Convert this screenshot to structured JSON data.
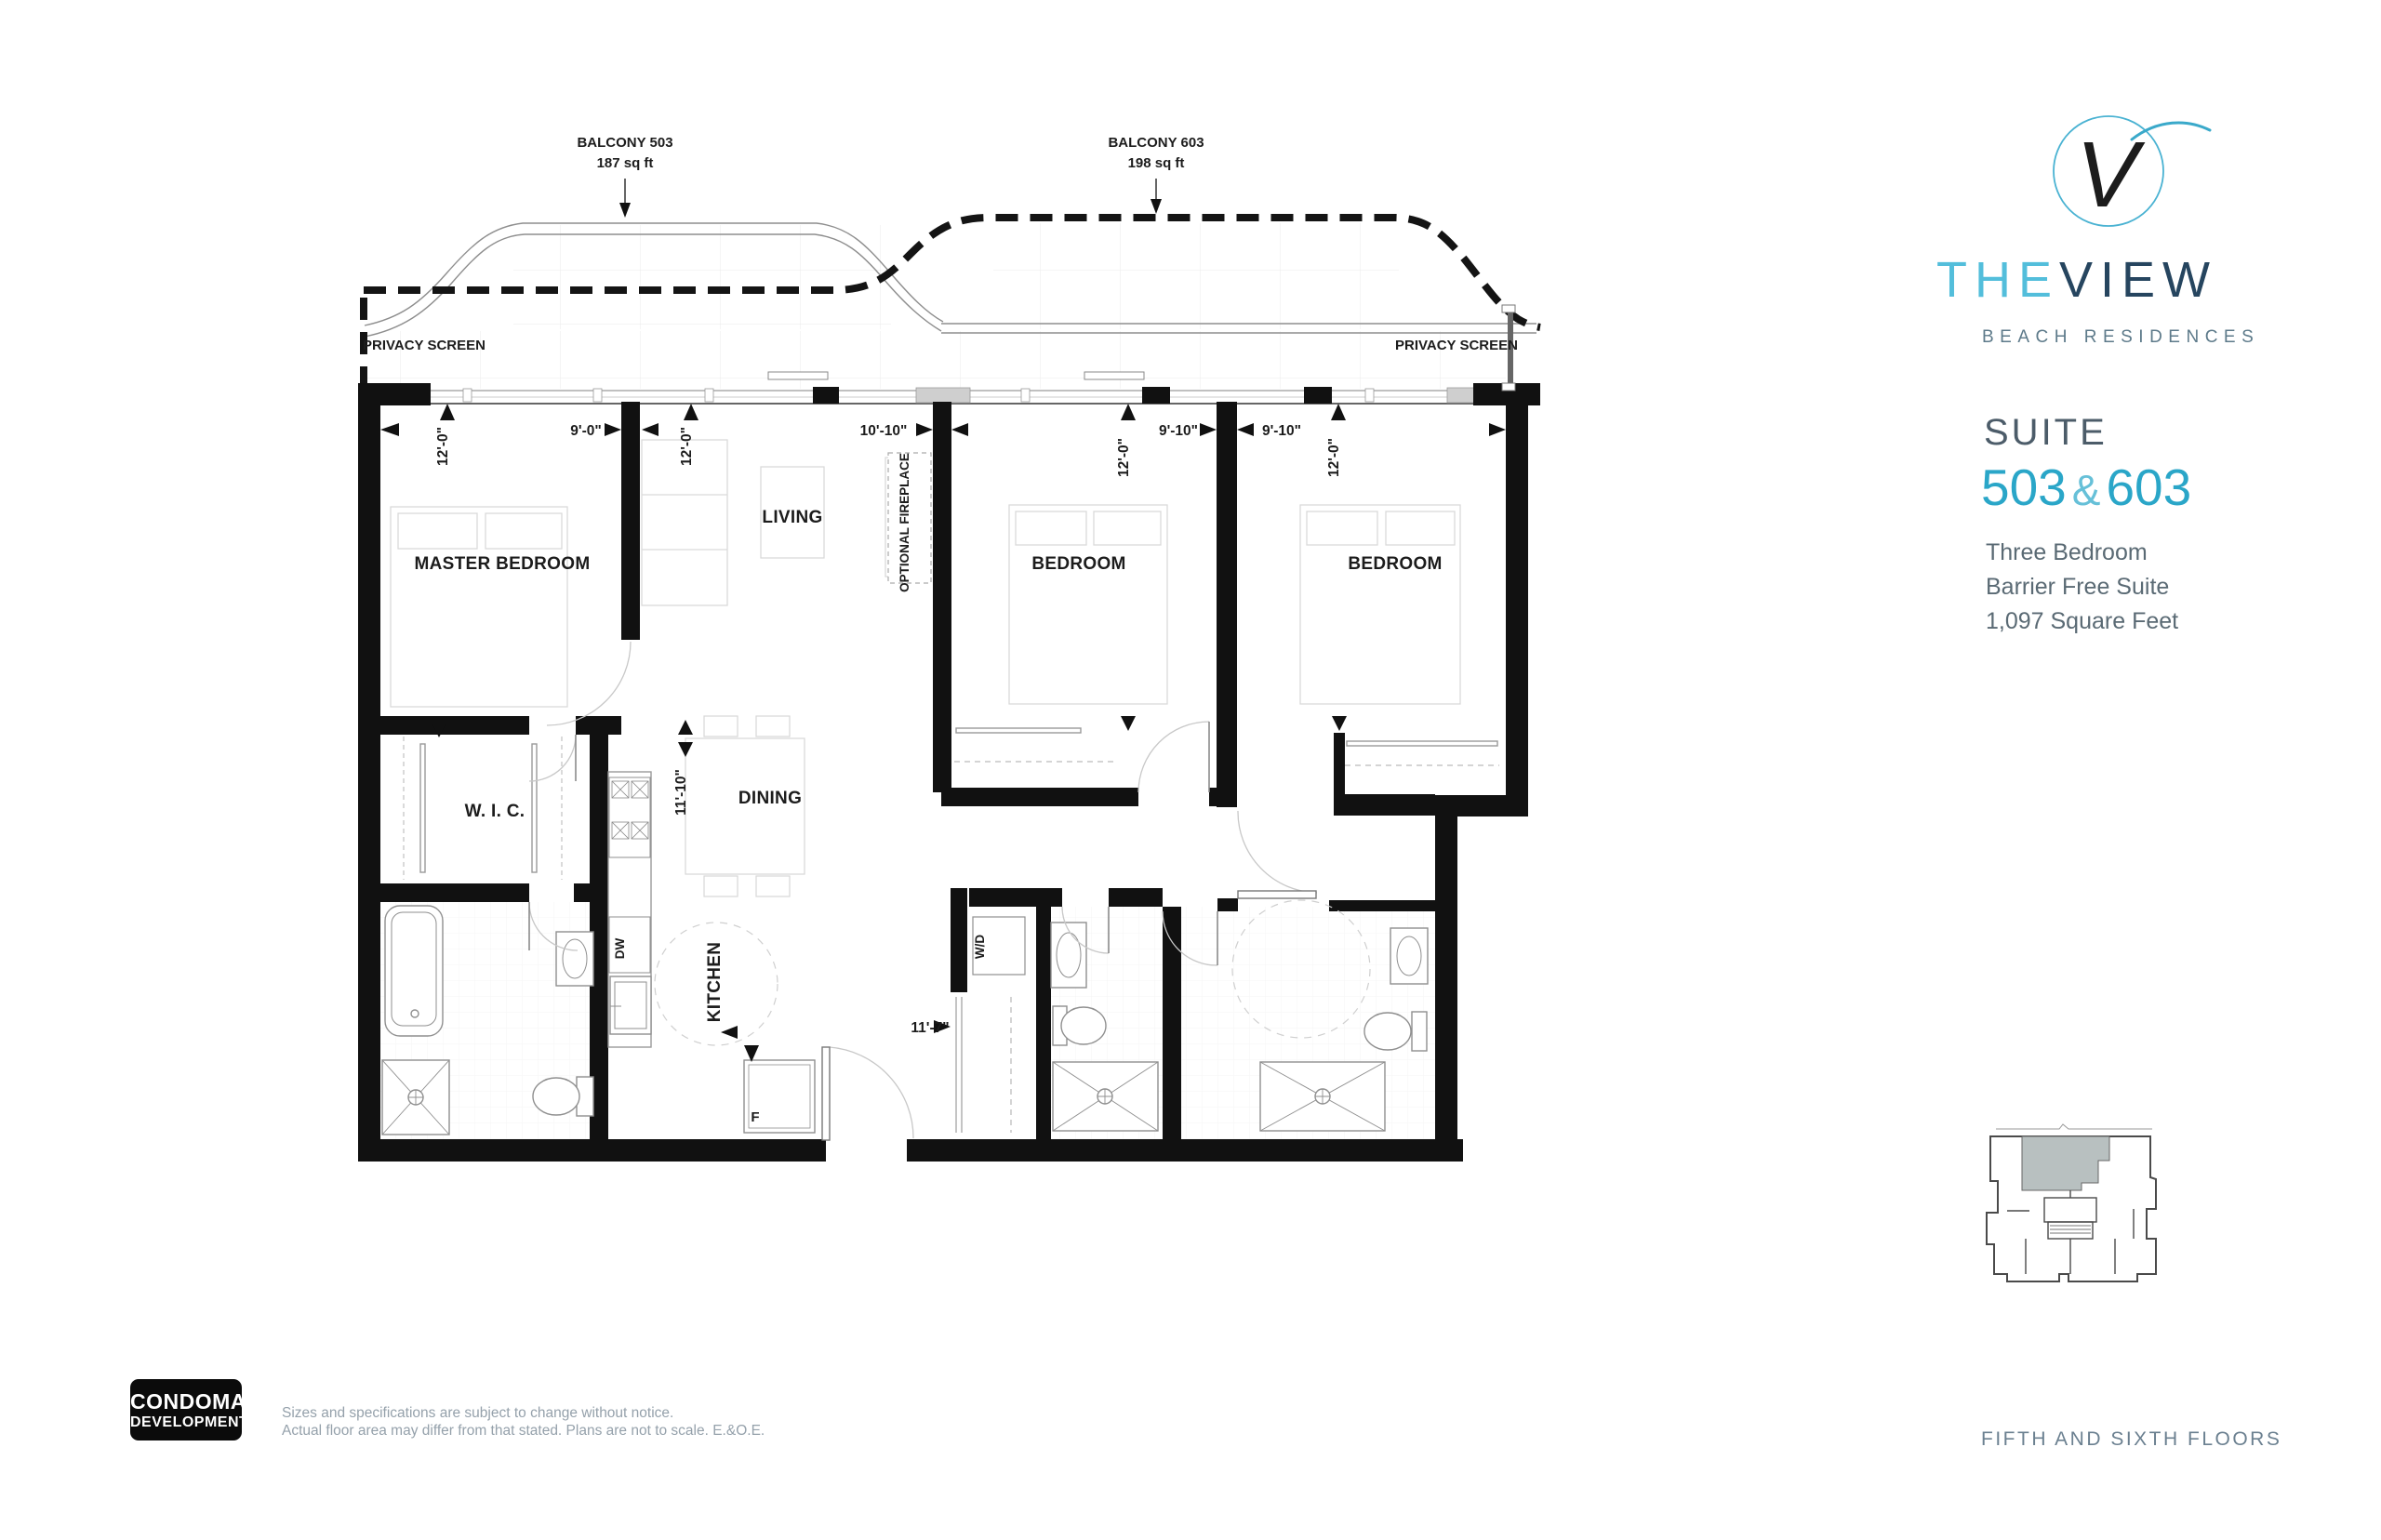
{
  "branding": {
    "monogram": "V",
    "the": "THE",
    "view": "VIEW",
    "tagline": "BEACH RESIDENCES"
  },
  "suite": {
    "heading": "SUITE",
    "num_left": "503",
    "ampersand": "&",
    "num_right": "603",
    "features": [
      "Three Bedroom",
      "Barrier Free Suite",
      "1,097 Square Feet"
    ]
  },
  "keyplan": {
    "caption": "FIFTH AND SIXTH FLOORS"
  },
  "developer": {
    "name": "CONDOMAN",
    "type": "DEVELOPMENTS"
  },
  "disclaimer": {
    "line1": "Sizes and specifications are subject to change without notice.",
    "line2": "Actual floor area may differ from that stated. Plans are not to scale. E.&O.E."
  },
  "plan": {
    "balcony_503": {
      "name": "BALCONY 503",
      "area": "187 sq ft"
    },
    "balcony_603": {
      "name": "BALCONY 603",
      "area": "198 sq ft"
    },
    "privacy_left": "PRIVACY SCREEN",
    "privacy_right": "PRIVACY SCREEN",
    "rooms": {
      "master": "MASTER BEDROOM",
      "living": "LIVING",
      "dining": "DINING",
      "kitchen": "KITCHEN",
      "wic": "W. I. C.",
      "bedroom_mid": "BEDROOM",
      "bedroom_right": "BEDROOM",
      "fireplace": "OPTIONAL FIREPLACE"
    },
    "appliances": {
      "dishwasher": "DW",
      "washer_dryer": "W/D",
      "fridge": "F"
    },
    "dims": {
      "master_w": "12'-0\"",
      "master_d": "9'-0\"",
      "living_w": "12'-0\"",
      "living_d": "10'-10\"",
      "bed_mid_w": "12'-0\"",
      "bed_mid_d": "9'-10\"",
      "bed_right_d": "9'-10\"",
      "bed_right_w": "12'-0\"",
      "dining_d": "11'-10\"",
      "hall_w": "11'-7\""
    }
  }
}
